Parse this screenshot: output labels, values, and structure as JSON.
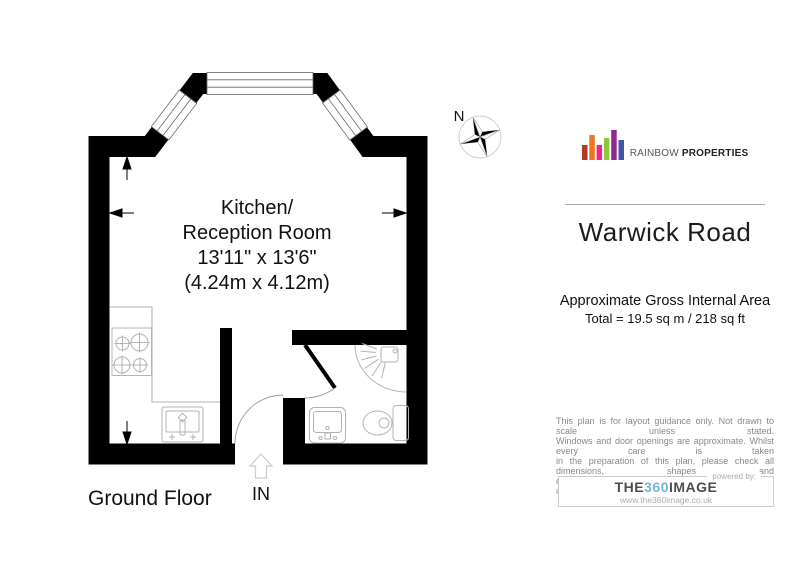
{
  "floorplan": {
    "room": {
      "name_line1": "Kitchen/",
      "name_line2": "Reception Room",
      "dimensions_imperial": "13'11\" x 13'6\"",
      "dimensions_metric": "(4.24m x 4.12m)"
    },
    "floor_label": "Ground Floor",
    "entrance_label": "IN",
    "compass_north_label": "N"
  },
  "sidebar": {
    "brand": {
      "name_regular": "RAINBOW",
      "name_bold": " PROPERTIES",
      "bar_colors": [
        "#b23b26",
        "#ee7623",
        "#ec268f",
        "#8dc63f",
        "#92278f",
        "#4156a6"
      ]
    },
    "property_title": "Warwick Road",
    "area_heading": "Approximate Gross Internal Area",
    "area_total": "Total = 19.5 sq m / 218 sq ft",
    "disclaimer_lines": [
      "This plan is for layout guidance only. Not drawn to scale unless stated.",
      "Windows and door openings are approximate. Whilst every care is taken",
      "in the preparation of this plan, please check all dimensions, shapes and",
      "compass bearings before making any decisions reliant upon them."
    ],
    "powered_by_label": "powered by:",
    "provider": {
      "part1": "THE",
      "part2": "360",
      "part3": "IMAGE",
      "accent_color": "#72b5d8",
      "url": "www.the360image.co.uk"
    }
  }
}
